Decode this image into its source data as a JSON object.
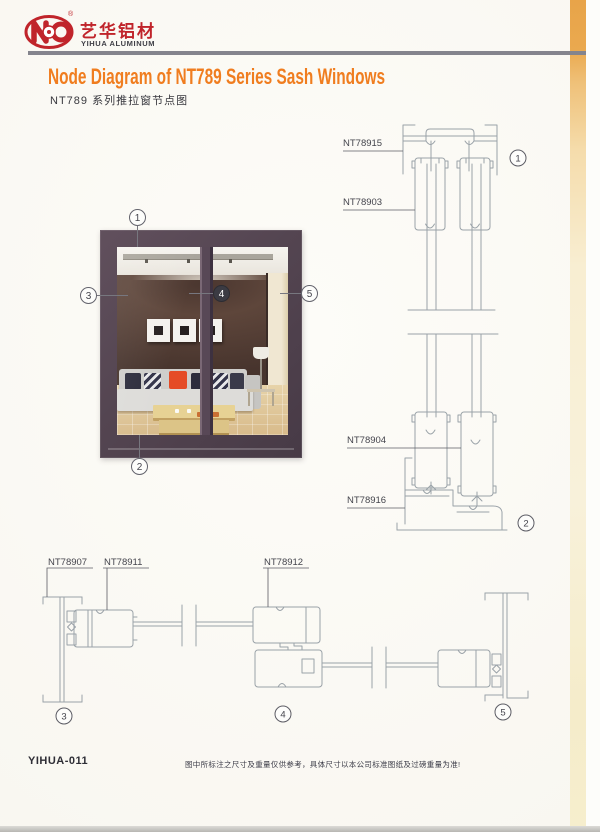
{
  "brand": {
    "name_cn": "艺华铝材",
    "name_en": "YIHUA ALUMINUM",
    "registered": "®",
    "logo_color": "#c0242b"
  },
  "header": {
    "title_en": "Node Diagram of NT789 Series Sash Windows",
    "title_cn": "NT789 系列推拉窗节点图",
    "accent_color": "#f07d1f"
  },
  "photo": {
    "callouts": [
      "1",
      "2",
      "3",
      "4",
      "5"
    ],
    "frame_color": "#544551"
  },
  "vertical_section": {
    "labels": [
      {
        "text": "NT78915"
      },
      {
        "text": "NT78903"
      },
      {
        "text": "NT78904"
      },
      {
        "text": "NT78916"
      }
    ],
    "callouts": [
      "1",
      "2"
    ]
  },
  "horizontal_section": {
    "labels": [
      {
        "text": "NT78907"
      },
      {
        "text": "NT78911"
      },
      {
        "text": "NT78912"
      }
    ],
    "callouts": [
      "3",
      "4",
      "5"
    ]
  },
  "footer": {
    "code": "YIHUA-011",
    "disclaimer": "图中所标注之尺寸及重量仅供参考，具体尺寸以本公司标准图纸及过磅重量为准!"
  }
}
